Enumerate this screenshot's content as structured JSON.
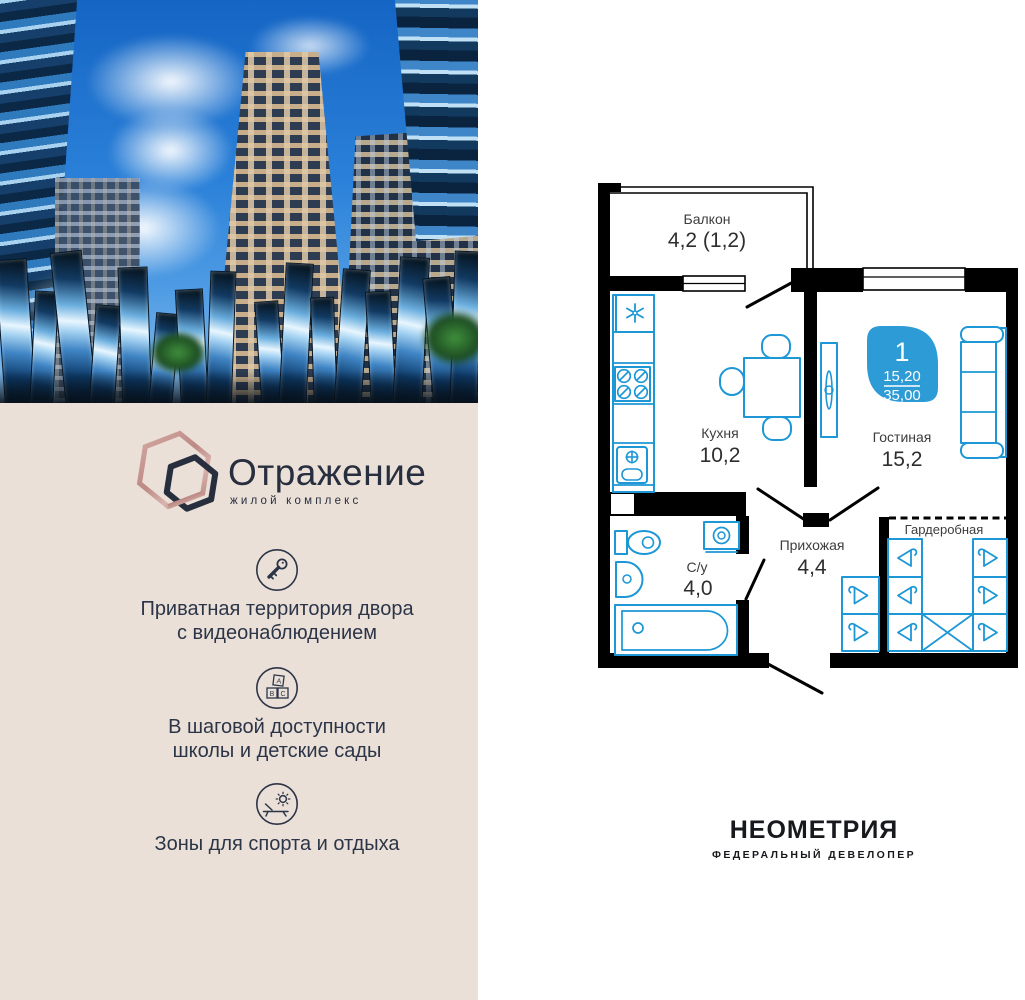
{
  "brand": {
    "name": "Отражение",
    "subtitle": "жилой комплекс"
  },
  "features": [
    {
      "icon": "key-icon",
      "line1": "Приватная территория двора",
      "line2": "с видеонаблюдением"
    },
    {
      "icon": "abc-blocks-icon",
      "line1": "В шаговой доступности",
      "line2": "школы и детские сады"
    },
    {
      "icon": "lounge-sun-icon",
      "line1": "Зоны для спорта и отдыха",
      "line2": ""
    }
  ],
  "abc": {
    "a": "A",
    "b": "B",
    "c": "C"
  },
  "plan": {
    "badge": {
      "rooms": "1",
      "living_area": "15,20",
      "total_area": "35,00"
    },
    "rooms": {
      "balcony": {
        "name": "Балкон",
        "area": "4,2 (1,2)"
      },
      "kitchen": {
        "name": "Кухня",
        "area": "10,2"
      },
      "living": {
        "name": "Гостиная",
        "area": "15,2"
      },
      "bathroom": {
        "name": "С/у",
        "area": "4,0"
      },
      "hall": {
        "name": "Прихожая",
        "area": "4,4"
      },
      "wardrobe": {
        "name": "Гардеробная"
      }
    }
  },
  "developer": {
    "name": "НЕОМЕТРИЯ",
    "tagline": "ФЕДЕРАЛЬНЫЙ ДЕВЕЛОПЕР"
  },
  "colors": {
    "accent_blue": "#1d97d5",
    "badge_blue": "#2c9bd6",
    "beige": "#eae0d8",
    "navy": "#272e3d",
    "rose": "#c5908c",
    "wall_black": "#000000"
  }
}
